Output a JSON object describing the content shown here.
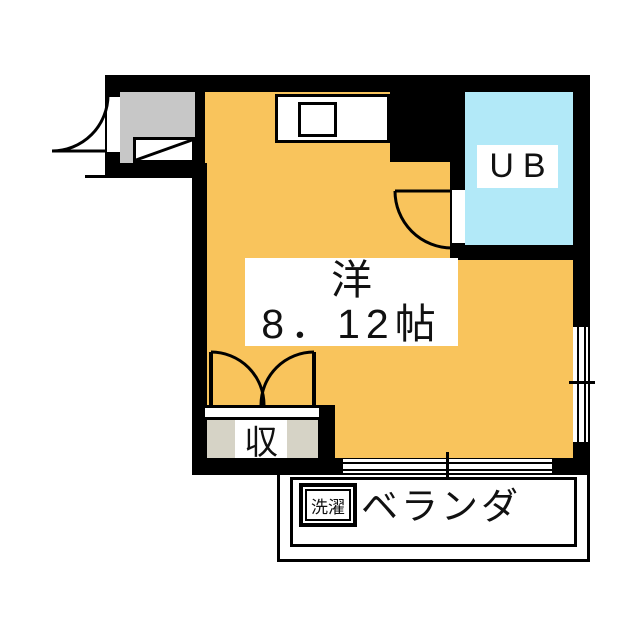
{
  "floorplan": {
    "room": {
      "label_line1": "洋",
      "label_line2": "8．12帖"
    },
    "unit_bath": {
      "label": "UB"
    },
    "closet": {
      "label": "収"
    },
    "balcony": {
      "label": "ベランダ",
      "laundry_label": "洗濯"
    },
    "colors": {
      "wall": "#000000",
      "room_floor": "#f9c45c",
      "unit_bath_floor": "#b2e9f8",
      "entry_floor": "#c7c7c7",
      "closet_floor": "#d6d3c6"
    }
  }
}
